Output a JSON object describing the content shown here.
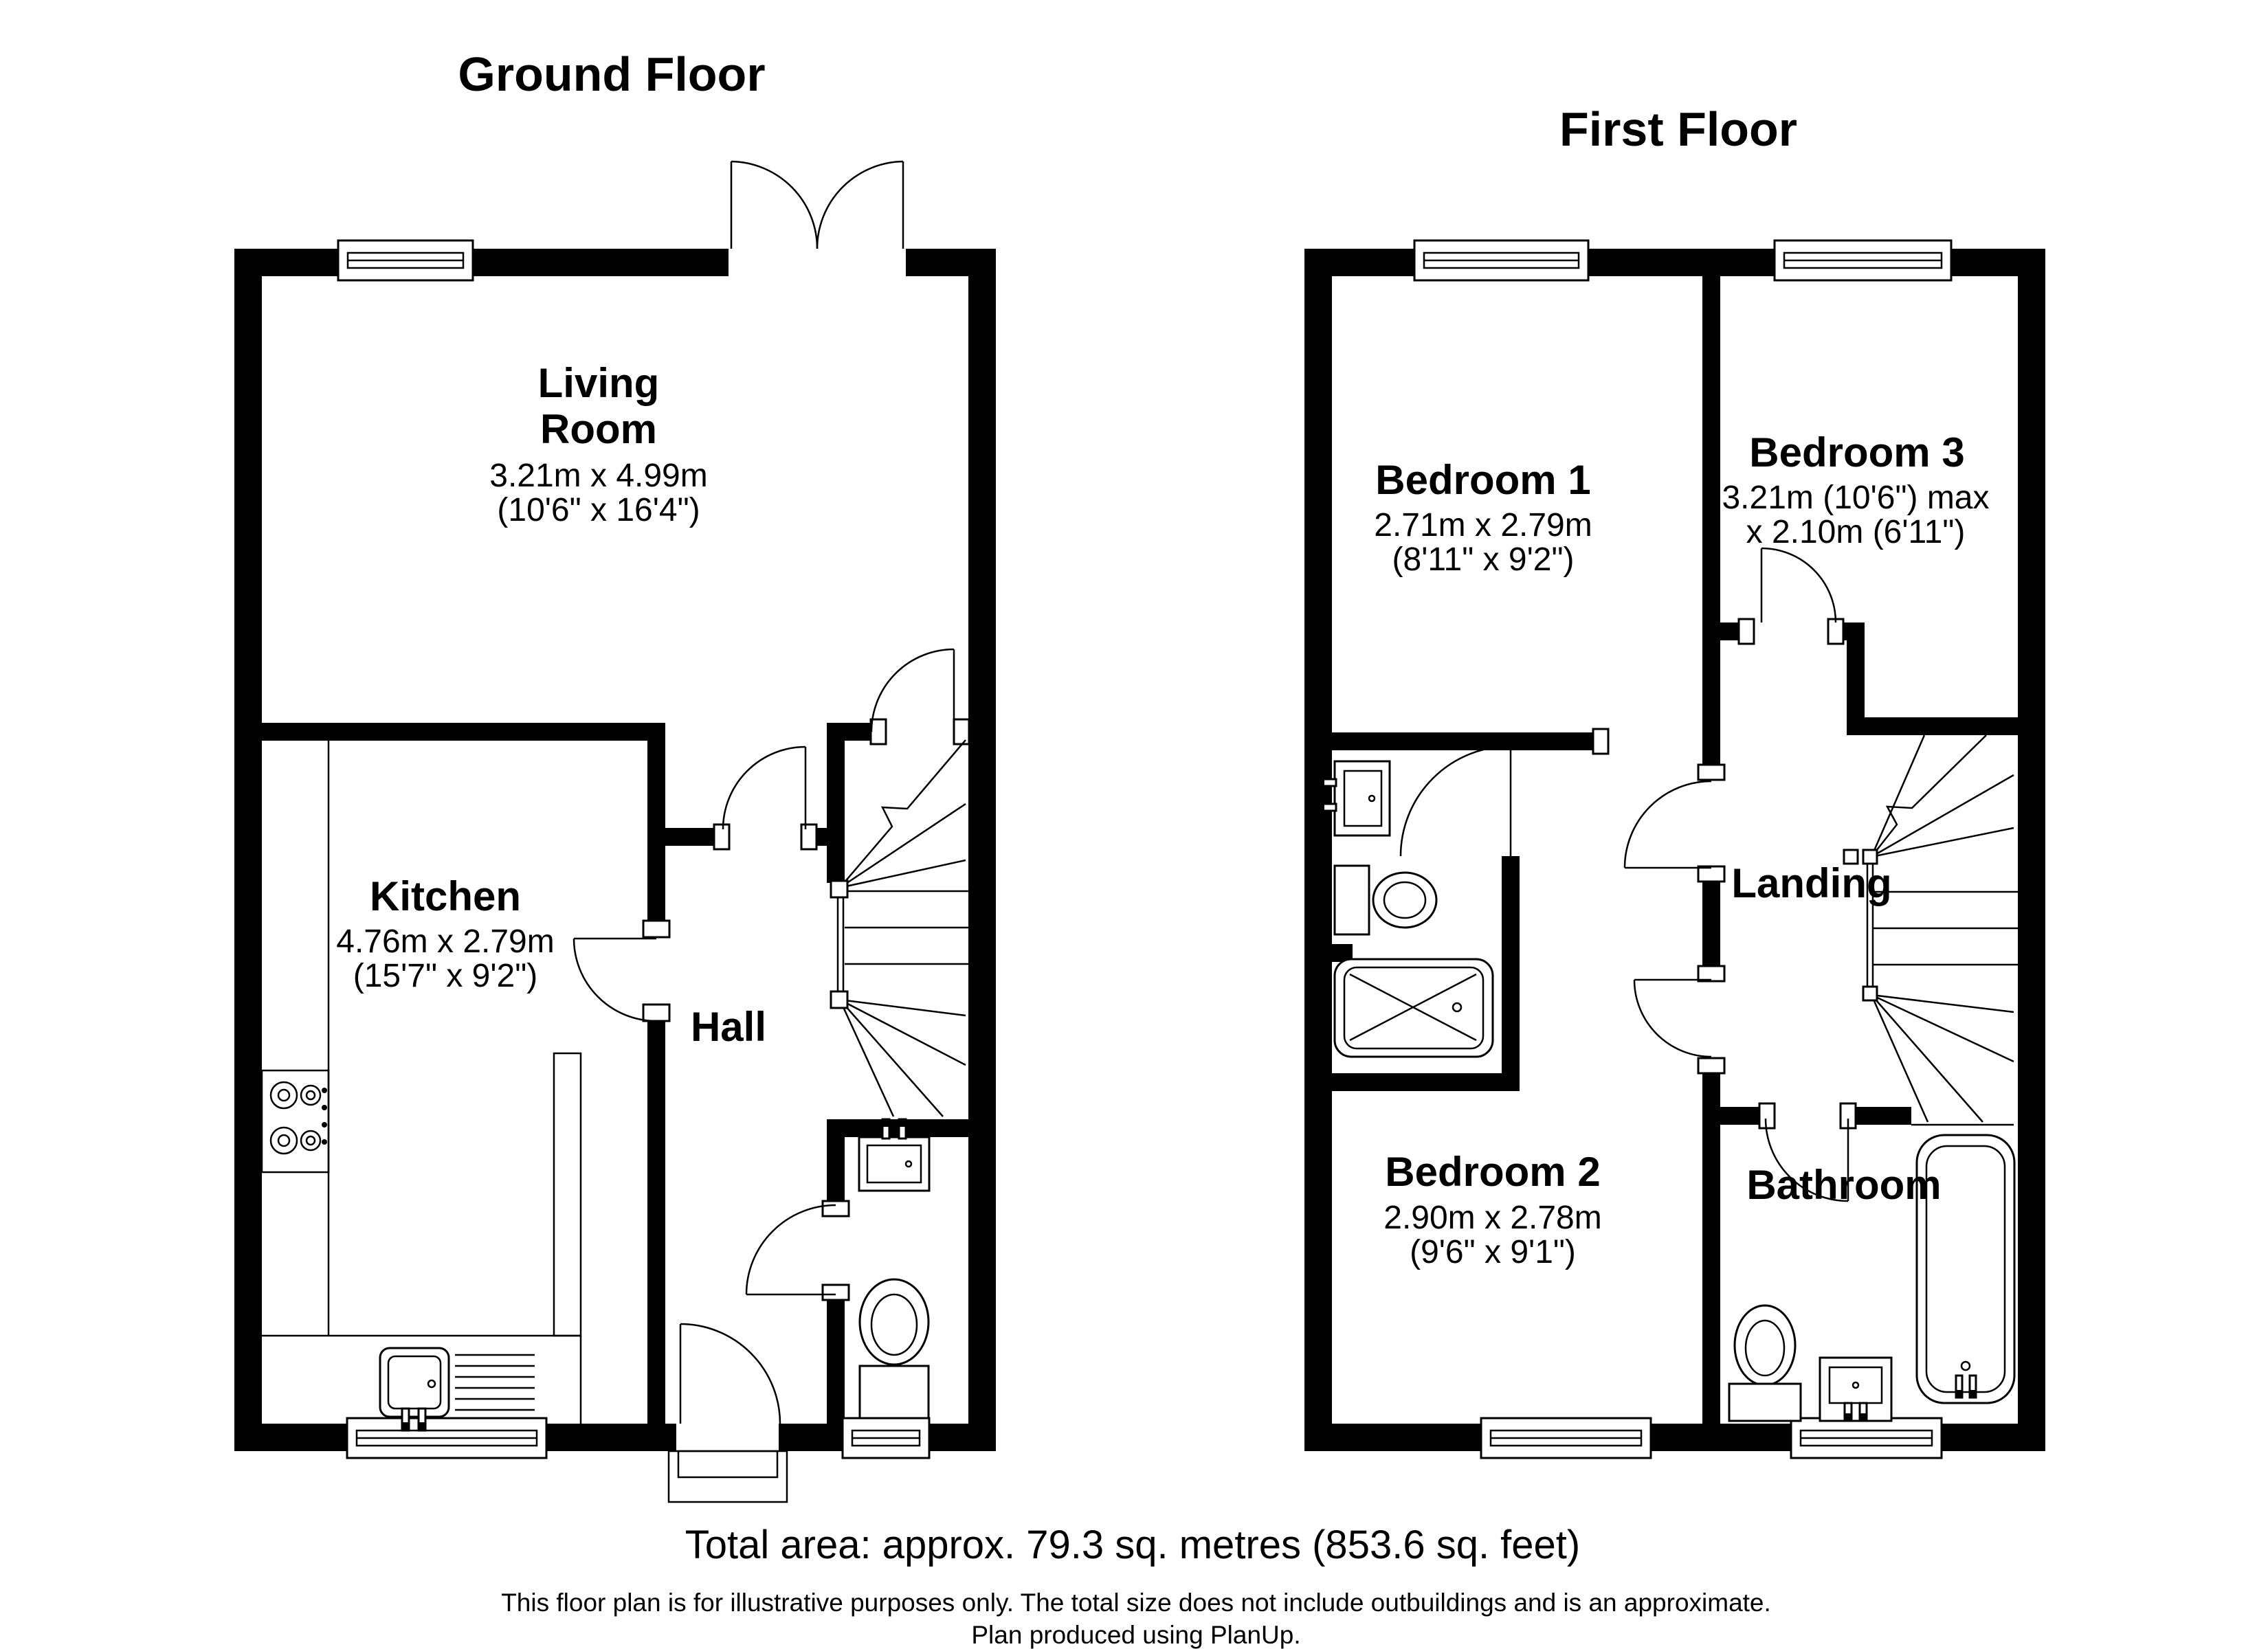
{
  "colors": {
    "ink": "#000000",
    "paper": "#ffffff"
  },
  "ground_floor": {
    "title": "Ground Floor",
    "living_room": {
      "line1": "Living",
      "line2": "Room",
      "metric": "3.21m x 4.99m",
      "imperial": "(10'6\" x 16'4\")"
    },
    "kitchen": {
      "name": "Kitchen",
      "metric": "4.76m x 2.79m",
      "imperial": "(15'7\" x 9'2\")"
    },
    "hall": {
      "name": "Hall"
    }
  },
  "first_floor": {
    "title": "First Floor",
    "bedroom1": {
      "name": "Bedroom 1",
      "metric": "2.71m x 2.79m",
      "imperial": "(8'11\" x 9'2\")"
    },
    "bedroom3": {
      "name": "Bedroom 3",
      "metric": "3.21m (10'6\") max",
      "imperial": "x 2.10m (6'11\")"
    },
    "bedroom2": {
      "name": "Bedroom 2",
      "metric": "2.90m x 2.78m",
      "imperial": "(9'6\" x 9'1\")"
    },
    "landing": {
      "name": "Landing"
    },
    "bathroom": {
      "name": "Bathroom"
    }
  },
  "footer": {
    "total_area": "Total area: approx. 79.3 sq. metres (853.6 sq. feet)",
    "disclaimer": "This floor plan is for illustrative purposes only. The total size does not include outbuildings and is an approximate.",
    "credit": "Plan produced using PlanUp."
  }
}
